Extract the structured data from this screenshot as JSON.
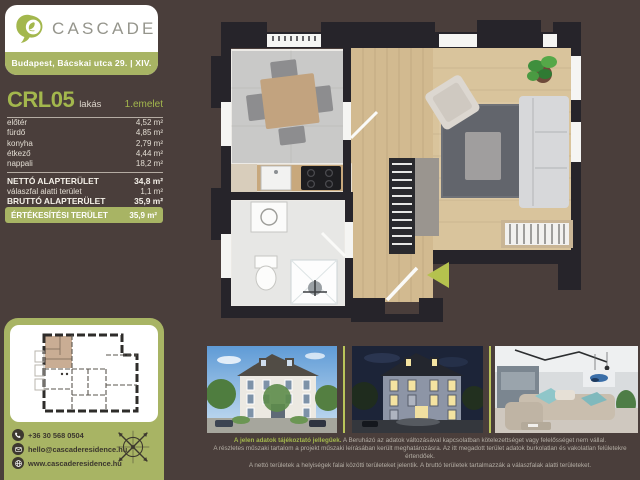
{
  "theme": {
    "background": "#4a3e3b",
    "accent_green": "#a8b464",
    "text_green": "#a3b74d",
    "arrow_green": "#b5c24e",
    "wall_color": "#26242a"
  },
  "brand": {
    "name": "CASCADE",
    "address": "Budapest, Bácskai utca 29. | XIV.",
    "logo_icon": "leaf-logo-icon"
  },
  "unit": {
    "code": "CRL05",
    "type": "lakás",
    "floor": "1.emelet"
  },
  "rooms": [
    {
      "name": "előtér",
      "area": "4,52 m²"
    },
    {
      "name": "fürdő",
      "area": "4,85 m²"
    },
    {
      "name": "konyha",
      "area": "2,79 m²"
    },
    {
      "name": "étkező",
      "area": "4,44 m²"
    },
    {
      "name": "nappali",
      "area": "18,2 m²"
    }
  ],
  "totals": {
    "net": {
      "label": "NETTÓ ALAPTERÜLET",
      "value": "34,8 m²"
    },
    "partition": {
      "label": "válaszfal alatti terület",
      "value": "1,1 m²"
    },
    "gross": {
      "label": "BRUTTÓ ALAPTERÜLET",
      "value": "35,9 m²"
    },
    "sales": {
      "label": "ÉRTÉKESÍTÉSI TERÜLET",
      "value": "35,9 m²"
    }
  },
  "contact": {
    "phone": {
      "icon": "phone-icon",
      "text": "+36 30 568 0504"
    },
    "email": {
      "icon": "email-icon",
      "text": "hello@cascaderesidence.hu"
    },
    "website": {
      "icon": "globe-icon",
      "text": "www.cascaderesidence.hu"
    }
  },
  "floorplan": {
    "entrance_arrow": "entrance-arrow-icon",
    "compass": "compass-rose-icon",
    "highlighted_unit_color": "#c9ad94"
  },
  "photos": [
    {
      "name": "exterior-day-rendering"
    },
    {
      "name": "exterior-night-rendering"
    },
    {
      "name": "interior-living-room-rendering"
    }
  ],
  "disclaimer": {
    "lead": "A jelen adatok tájékoztató jellegűek.",
    "line1": "A Beruházó az adatok változásával kapcsolatban kötelezettséget vagy felelősséget nem vállal.",
    "line2": "A részletes műszaki tartalom a projekt műszaki leírásában került meghatározásra. Az itt megadott terület adatok burkolatlan és vakolatlan felületekre értendőek.",
    "line3": "A nettó területek a helyiségek falai közötti területeket jelentik. A bruttó területek tartalmazzák a válaszfalak alatti területeket."
  }
}
